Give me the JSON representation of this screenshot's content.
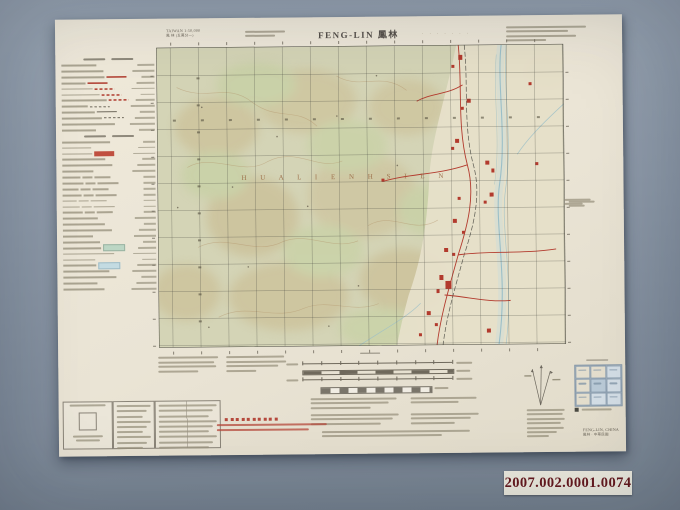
{
  "photo": {
    "catalog_label": "2007.002.0001.0074"
  },
  "map": {
    "series_title": "TAIWAN 1:50,000",
    "series_subtitle": "鳳 林 (五萬分一)",
    "title": "FENG-LIN 鳳林",
    "projection_marks": "· · · · · · ·",
    "map_region_text": "H U A L I E N    H S I E N",
    "corner_name": "FENG-LIN, CHINA",
    "corner_name_cn": "鳳林 · 中華民國",
    "grid": {
      "cols": 15,
      "rows": 11
    },
    "colors": {
      "paper": "#eae4d5",
      "terrain_green": "#d4d4b6",
      "valley": "#e7e1cb",
      "road_red": "#b33b2e",
      "river_blue": "#9bbfc8",
      "grid_line": "#4a4a42",
      "catalog_red": "#66191e"
    }
  },
  "legend": {
    "rows": [
      "hdr",
      "txt",
      "txt",
      "red",
      "red",
      "redd",
      "redd",
      "redd",
      "blkd",
      "blk",
      "blkd",
      "txt",
      "txt",
      "hdr",
      "txt",
      "txt",
      "redbox",
      "txt",
      "txt",
      "txt",
      "cols",
      "cols",
      "cols",
      "cols",
      "cols",
      "cols",
      "cols",
      "txt",
      "txt",
      "txt",
      "txt",
      "txt",
      "grnbox",
      "txt",
      "txt",
      "blubox",
      "txt",
      "txt",
      "txt",
      "txt"
    ]
  },
  "index_grid": {
    "title_bar_width": 44,
    "cells": [
      0,
      0,
      1,
      0,
      2,
      1,
      0,
      1,
      1
    ]
  },
  "illegible_text_blocks": [
    {
      "x": 190,
      "y": 13,
      "w": 42,
      "lines": [
        40,
        30
      ],
      "lh": 4,
      "color": "#99937f"
    },
    {
      "x": 451,
      "y": 11,
      "w": 82,
      "lines": [
        80,
        62,
        70,
        40
      ],
      "lh": 4.4,
      "color": "#99937f"
    },
    {
      "x": 100,
      "y": 338,
      "w": 62,
      "lines": [
        60,
        56,
        58,
        40
      ],
      "lh": 4.6,
      "color": "#99937f"
    },
    {
      "x": 168,
      "y": 338,
      "w": 62,
      "lines": [
        58,
        60,
        52,
        30
      ],
      "lh": 4.6,
      "color": "#99937f"
    },
    {
      "x": 252,
      "y": 381,
      "w": 88,
      "lines": [
        86,
        78,
        60
      ],
      "lh": 4.4,
      "color": "#99937f"
    },
    {
      "x": 352,
      "y": 381,
      "w": 70,
      "lines": [
        66,
        48
      ],
      "lh": 4.4,
      "color": "#99937f"
    },
    {
      "x": 252,
      "y": 397,
      "w": 90,
      "lines": [
        88,
        82,
        70
      ],
      "lh": 4.4,
      "color": "#99937f"
    },
    {
      "x": 352,
      "y": 397,
      "w": 70,
      "lines": [
        68,
        60,
        44
      ],
      "lh": 4.4,
      "color": "#99937f"
    },
    {
      "x": 263,
      "y": 414,
      "w": 150,
      "lines": [
        148,
        120
      ],
      "lh": 4.4,
      "color": "#99937f"
    },
    {
      "x": 276,
      "y": 404,
      "w": 140,
      "lines": [
        0
      ],
      "lh": 4,
      "color": "#99937f"
    },
    {
      "x": 158,
      "y": 406,
      "w": 112,
      "lines": [
        110,
        92
      ],
      "lh": 4.6,
      "color": "#b5493c"
    },
    {
      "x": 468,
      "y": 394,
      "w": 40,
      "lines": [
        38,
        36,
        38,
        34,
        37,
        30,
        22
      ],
      "lh": 4.4,
      "color": "#99937f"
    },
    {
      "x": 508,
      "y": 184,
      "w": 28,
      "lines": [
        26,
        18
      ],
      "lh": 4,
      "color": "#99937f"
    }
  ],
  "icons": {
    "declination": "declination-diagram",
    "adjoining": "index-to-adjoining-sheets"
  }
}
